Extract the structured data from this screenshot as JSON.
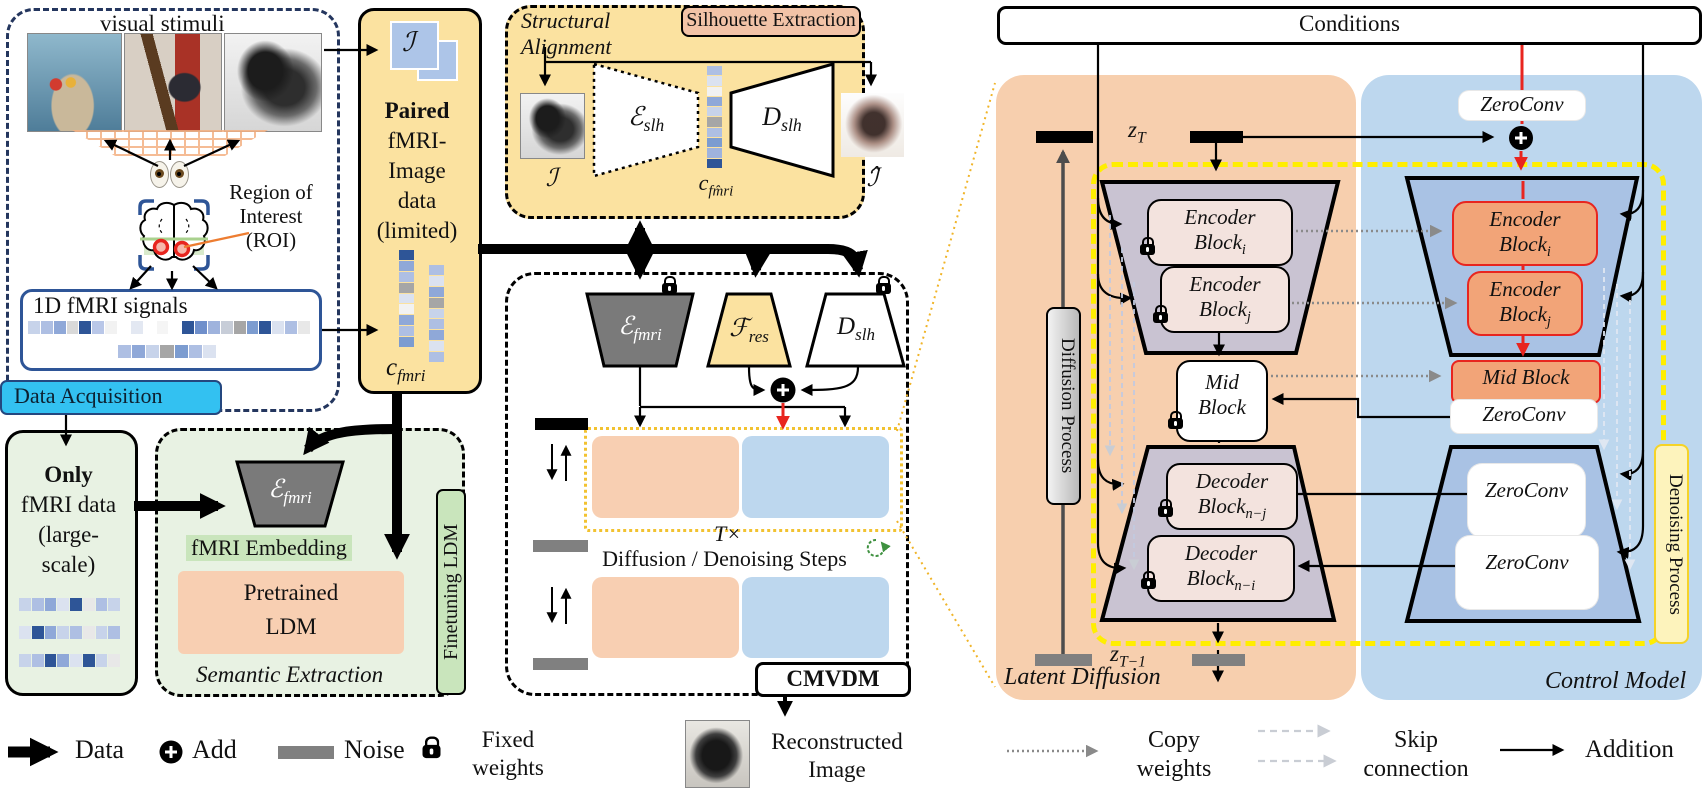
{
  "colors": {
    "yellow": "#fbe2a0",
    "salmon": "#f2c3a7",
    "orangePanel": "#f7cfae",
    "orangeBox": "#f8cfb2",
    "blue": "#bdd7ee",
    "blueDeep": "#a9c2e4",
    "green": "#e8f2e3",
    "greenHl": "#c9e5bc",
    "cyan": "#33c1f1",
    "navy": "#24365e",
    "signalNavy": "#2e5597",
    "lavender": "#c9c3d2",
    "blockPink": "#f3e3de",
    "blockOrange": "#f2a478",
    "red": "#e8251f",
    "yellowDash": "#ffee00",
    "gold": "#f0b428",
    "noiseGray": "#808080"
  },
  "acquisition": {
    "label": "Data Acquisition",
    "stimuli_title": "visual stimuli",
    "roi": [
      "Region of",
      "Interest",
      "(ROI)"
    ],
    "signals_title": "1D fMRI signals",
    "row_long": [
      "#c7d3ea",
      "#aebfe3",
      "#8fa8d8",
      "#d9d9d9",
      "#2e5597",
      "#b9c7e8",
      "#f2f2f2",
      "#ffffff",
      "#e3e8f2",
      "#ffffff",
      "#f5f5f5",
      "#ffffff",
      "#2e5597",
      "#6f8fcb",
      "#9fb3dd",
      "#c7cdd8",
      "#a6a6a6",
      "#7c9cd0",
      "#2e5597",
      "#dbe2f0",
      "#aebfe3",
      "#e8e8e8"
    ],
    "row_short": [
      "#aebfe3",
      "#8fa8d8",
      "#c7d3ea",
      "#a6a6a6",
      "#7c9cd0",
      "#aebfe3",
      "#dbe2f0"
    ]
  },
  "paired": {
    "lines": [
      "Paired",
      "fMRI-",
      "Image",
      "data",
      "(limited)"
    ],
    "symbol": "ℐ",
    "code_base": "c",
    "code_sub": "fmri",
    "col1": [
      "#2e5597",
      "#8fa8d8",
      "#aebfe3",
      "#a6a6a6",
      "#dbe2f0",
      "#f2f2f2",
      "#8fa8d8",
      "#aebfe3",
      "#7c9cd0"
    ],
    "col2": [
      "#aebfe3",
      "#dbe2f0",
      "#8fa8d8",
      "#a6a6a6",
      "#c7d3ea",
      "#aebfe3",
      "#8fa8d8",
      "#dbe2f0",
      "#aebfe3"
    ]
  },
  "silhouette": {
    "alignment": [
      "Structural",
      "Alignment"
    ],
    "title": "Silhouette Extraction",
    "enc_base": "ℰ",
    "enc_sub": "slh",
    "dec_base": "D",
    "dec_sub": "slh",
    "input_symbol": "ℐ",
    "output_symbol": "ℐ̂",
    "code_base": "c",
    "code_sub": "fm̂ri",
    "column": [
      "#aebfe3",
      "#dbe2f0",
      "#f2f2f2",
      "#8fa8d8",
      "#c7d3ea",
      "#a6a6a6",
      "#aebfe3",
      "#7c9cd0",
      "#9fb3dd",
      "#2e5597"
    ]
  },
  "semantic": {
    "only_lines": [
      "Only",
      "fMRI data",
      "(large-",
      "scale)"
    ],
    "rows": [
      [
        "#c7d3ea",
        "#aebfe3",
        "#8fa8d8",
        "#dbe2f0",
        "#2e5597",
        "#e8e8e8",
        "#aebfe3",
        "#c7d3ea"
      ],
      [
        "#dbe2f0",
        "#2e5597",
        "#8fa8d8",
        "#c7d3ea",
        "#aebfe3",
        "#e8e8e8",
        "#c7d3ea",
        "#aebfe3"
      ],
      [
        "#c7d3ea",
        "#aebfe3",
        "#2e5597",
        "#8fa8d8",
        "#dbe2f0",
        "#2e5597",
        "#c7d3ea",
        "#e8e8e8"
      ]
    ],
    "enc_base": "ℰ",
    "enc_sub": "fmri",
    "embedding": "fMRI Embedding",
    "pretrained": [
      "Pretrained",
      "LDM"
    ],
    "caption": "Semantic Extraction",
    "finetuning": "Finetuning LDM"
  },
  "cmvdm": {
    "enc_base": "ℰ",
    "enc_sub": "fmri",
    "res_base": "ℱ",
    "res_sub": "res",
    "dec_base": "D",
    "dec_sub": "slh",
    "t_times": "T×",
    "steps": "Diffusion / Denoising Steps",
    "tag": "CMVDM",
    "caption": [
      "Reconstructed",
      "Image"
    ]
  },
  "control": {
    "conditions": "Conditions",
    "zt_base": "z",
    "zt_sub": "T",
    "zt1_base": "z",
    "zt1_sub": "T−1",
    "zeroconv": "ZeroConv",
    "enc_i": {
      "l1": "Encoder",
      "l2": "Block",
      "sub": "i"
    },
    "enc_j": {
      "l1": "Encoder",
      "l2": "Block",
      "sub": "j"
    },
    "mid": [
      "Mid",
      "Block"
    ],
    "mid_right": "Mid Block",
    "dec_nj": {
      "l1": "Decoder",
      "l2": "Block",
      "sub": "n−j"
    },
    "dec_ni": {
      "l1": "Decoder",
      "l2": "Block",
      "sub": "n−i"
    },
    "diffusion": "Diffusion Process",
    "denoising": "Denoising Process",
    "latent": "Latent Diffusion",
    "model": "Control Model"
  },
  "legend": {
    "data": "Data",
    "add": "Add",
    "noise": "Noise",
    "fixed": [
      "Fixed",
      "weights"
    ],
    "copy": [
      "Copy",
      "weights"
    ],
    "skip": [
      "Skip",
      "connection"
    ],
    "addition": "Addition"
  }
}
